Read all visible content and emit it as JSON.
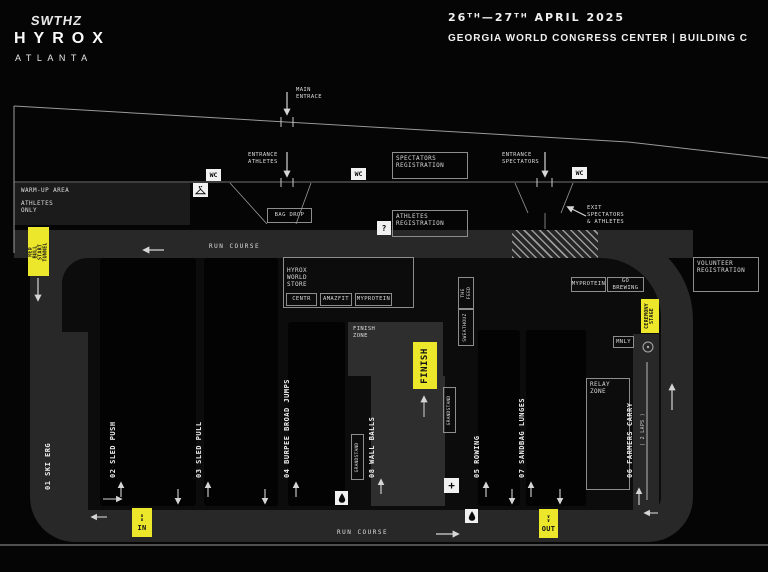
{
  "header": {
    "brand": "SWTHZ",
    "event": "HYROX",
    "city": "ATLANTA",
    "dates": "26ᵀᴴ—27ᵀᴴ APRIL 2025",
    "venue": "GEORGIA WORLD CONGRESS CENTER | BUILDING C"
  },
  "entrances": {
    "main": "MAIN\nENTRACE",
    "athletes": "ENTRANCE\nATHLETES",
    "spectators": "ENTRANCE\nSPECTATORS",
    "exit": "EXIT\nSPECTATORS\n& ATHLETES"
  },
  "registration": {
    "spectators": "SPECTATORS\nREGISTRATION",
    "athletes": "ATHLETES\nREGISTRATION",
    "volunteer": "VOLUNTEER\nREGISTRATION",
    "bag_drop": "BAG DROP"
  },
  "warmup": {
    "area": "WARM-UP AREA",
    "restriction": "ATHLETES\nONLY"
  },
  "course": {
    "run_course": "RUN COURSE",
    "start_tunnel": "RED BULL\nSTART TUNNEL",
    "finish": "FINISH",
    "finish_zone": "FINISH\nZONE",
    "relay_zone": "RELAY\nZONE",
    "ceremony_stage": "CEREMONY\nSTAGE",
    "gate_in": "IN",
    "gate_out": "OUT",
    "chevrons_in": "∧\n∧",
    "chevrons_out": "∨\n∨"
  },
  "stations": [
    {
      "label": "01 SKI ERG"
    },
    {
      "label": "02 SLED PUSH"
    },
    {
      "label": "03 SLED PULL"
    },
    {
      "label": "04 BURPEE BROAD JUMPS"
    },
    {
      "label": "08 WALL BALLS"
    },
    {
      "label": "05 ROWING"
    },
    {
      "label": "07 SANDBAG LUNGES"
    },
    {
      "label": "06 FARMERS CARRY",
      "note": "( 2 LAPS )"
    }
  ],
  "store": {
    "title": "HYROX\nWORLD\nSTORE",
    "brands": [
      "CENTR",
      "AMAZFIT",
      "MYPROTEIN"
    ]
  },
  "sponsors": {
    "myprotein": "MYPROTEIN",
    "go_brewing": "GO BREWING",
    "mnly": "MNLY",
    "sweathouz": "SWEATHOUZ",
    "the_feed": "THE FEED"
  },
  "facilities": {
    "wc": "WC",
    "info": "?",
    "medical": "+",
    "grandstand": "GRANDSTAND"
  },
  "colors": {
    "accent_yellow": "#ECE72A",
    "track_gray": "#282828",
    "background": "#050505"
  }
}
